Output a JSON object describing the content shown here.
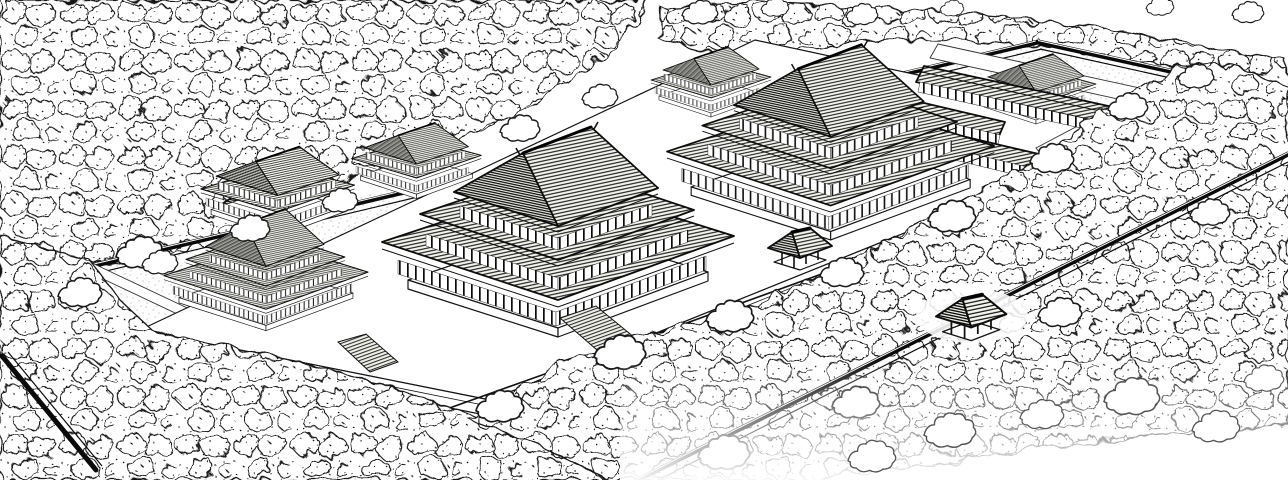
{
  "illustration": {
    "type": "black-and-white ink line drawing",
    "subject": "Bird's-eye reconstruction drawing of an ancient walled palace compound with tiered pavilion halls, rear pavilions, corridor wings, wall gates and courtyards, surrounded by dense forest",
    "view": "isometric aerial view, compound axis running from lower-left to upper-right"
  },
  "colors": {
    "paper": "#ffffff",
    "ink": "#111111",
    "ink_soft": "#555555",
    "speckle": "#a8a8a0"
  },
  "scene": {
    "main_halls": 3,
    "rear_pavilions": 3,
    "rear_hall": 1,
    "corridor_wings": 4,
    "wall_gates": 3,
    "stair_ramps": 2,
    "elements": [
      "forest canopy",
      "perimeter wall",
      "inner fence",
      "raised terrace",
      "stairs",
      "courtyard paths",
      "tiered pavilion halls",
      "rear pavilions",
      "corridor wings",
      "wall gates"
    ]
  }
}
